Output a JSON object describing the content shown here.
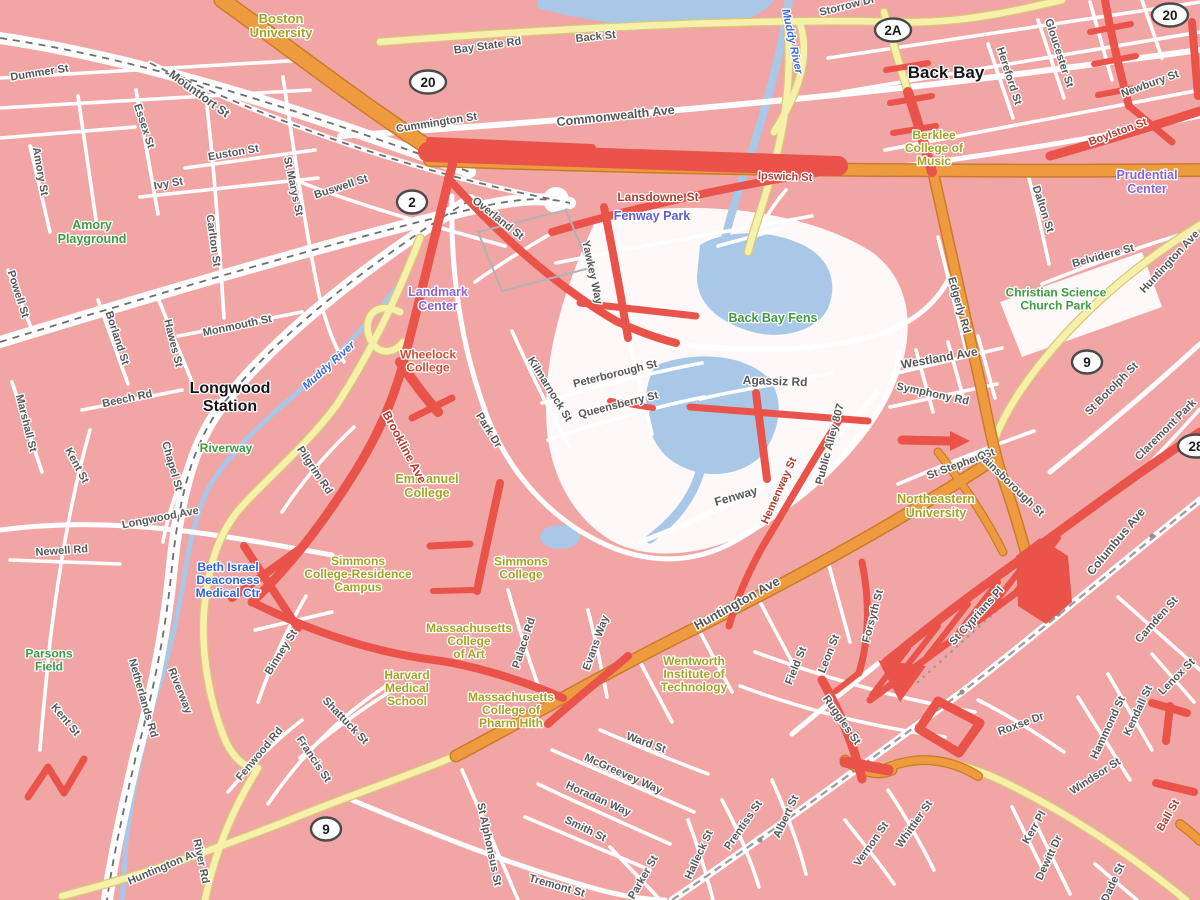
{
  "map_colors": {
    "land_pink": "#f2a5a5",
    "road_white": "#ffffff",
    "road_yellow": "#f7f0ab",
    "highway_orange": "#ee9b40",
    "traffic_heavy_red": "#e9534a",
    "water_blue": "#a9c8e8"
  },
  "labels": [
    {
      "t": "Boston\nUniversity",
      "x": 281,
      "y": 30,
      "c": "campus",
      "s": 13
    },
    {
      "t": "Amory\nPlayground",
      "x": 92,
      "y": 236,
      "c": "park",
      "s": 12.5
    },
    {
      "t": "Back Bay Fens",
      "x": 773,
      "y": 322,
      "c": "park",
      "s": 12.5
    },
    {
      "t": "Riverway",
      "x": 226,
      "y": 452,
      "c": "park",
      "s": 12
    },
    {
      "t": "Parsons\nField",
      "x": 49,
      "y": 664,
      "c": "park",
      "s": 12
    },
    {
      "t": "Christian Science\nChurch Park",
      "x": 1056,
      "y": 303,
      "c": "park",
      "s": 12
    },
    {
      "t": "Landmark\nCenter",
      "x": 438,
      "y": 303,
      "c": "poi-purple",
      "s": 12.5
    },
    {
      "t": "Prudential\nCenter",
      "x": 1147,
      "y": 186,
      "c": "poi-purple",
      "s": 12.5
    },
    {
      "t": "Fenway Park",
      "x": 652,
      "y": 220,
      "c": "fenway",
      "s": 12.5
    },
    {
      "t": "Lansdowne St",
      "x": 658,
      "y": 201,
      "c": "street-red",
      "s": 12
    },
    {
      "t": "Wheelock\nCollege",
      "x": 428,
      "y": 365,
      "c": "poi-red",
      "s": 12
    },
    {
      "t": "Beth Israel\nDeaconess\nMedical Ctr",
      "x": 228,
      "y": 584,
      "c": "poi-blue",
      "s": 12
    },
    {
      "t": "Berklee\nCollege of\nMusic",
      "x": 934,
      "y": 152,
      "c": "campus",
      "s": 12
    },
    {
      "t": "Emmanuel\nCollege",
      "x": 427,
      "y": 490,
      "c": "campus",
      "s": 12.5
    },
    {
      "t": "Simmons\nCollege-Residence\nCampus",
      "x": 358,
      "y": 578,
      "c": "campus",
      "s": 12
    },
    {
      "t": "Simmons\nCollege",
      "x": 521,
      "y": 572,
      "c": "campus",
      "s": 12
    },
    {
      "t": "Massachusetts\nCollege\nof Art",
      "x": 469,
      "y": 645,
      "c": "campus",
      "s": 12
    },
    {
      "t": "Harvard\nMedical\nSchool",
      "x": 407,
      "y": 692,
      "c": "campus",
      "s": 12
    },
    {
      "t": "Massachusetts\nCollege of\nPharm Hlth",
      "x": 511,
      "y": 714,
      "c": "campus",
      "s": 12
    },
    {
      "t": "Wentworth\nInstitute of\nTechnology",
      "x": 694,
      "y": 678,
      "c": "campus",
      "s": 12
    },
    {
      "t": "Northeastern\nUniversity",
      "x": 936,
      "y": 510,
      "c": "campus",
      "s": 12.5
    },
    {
      "t": "Back Bay",
      "x": 946,
      "y": 78,
      "c": "station",
      "s": 17
    },
    {
      "t": "Longwood\nStation",
      "x": 230,
      "y": 402,
      "c": "station",
      "s": 16
    },
    {
      "t": "Muddy River",
      "x": 331,
      "y": 368,
      "r": -42,
      "c": "water"
    },
    {
      "t": "Muddy River",
      "x": 789,
      "y": 42,
      "r": 78,
      "c": "water"
    },
    {
      "t": "Dummer St",
      "x": 40,
      "y": 76,
      "r": -9
    },
    {
      "t": "Mountfort St",
      "x": 197,
      "y": 97,
      "r": 36,
      "s": 12
    },
    {
      "t": "Essex St",
      "x": 141,
      "y": 127,
      "r": 72
    },
    {
      "t": "Euston St",
      "x": 234,
      "y": 156,
      "r": -10
    },
    {
      "t": "Ivy St",
      "x": 169,
      "y": 187,
      "r": -10
    },
    {
      "t": "Amory St",
      "x": 37,
      "y": 172,
      "r": 80
    },
    {
      "t": "Carlton St",
      "x": 210,
      "y": 241,
      "r": 82
    },
    {
      "t": "St Marys St",
      "x": 290,
      "y": 187,
      "r": 78
    },
    {
      "t": "Buswell St",
      "x": 342,
      "y": 190,
      "r": -18
    },
    {
      "t": "Cummington St",
      "x": 437,
      "y": 126,
      "r": -9
    },
    {
      "t": "Bay State Rd",
      "x": 488,
      "y": 49,
      "r": -8
    },
    {
      "t": "Back St",
      "x": 596,
      "y": 40,
      "r": -6
    },
    {
      "t": "Commonwealth Ave",
      "x": 616,
      "y": 120,
      "r": -6,
      "s": 12.5
    },
    {
      "t": "Storrow Dr",
      "x": 848,
      "y": 9,
      "r": -14
    },
    {
      "t": "Hereford St",
      "x": 1006,
      "y": 77,
      "r": 72
    },
    {
      "t": "Gloucester St",
      "x": 1056,
      "y": 54,
      "r": 72
    },
    {
      "t": "Newbury St",
      "x": 1151,
      "y": 87,
      "r": -20
    },
    {
      "t": "Boylston St",
      "x": 1119,
      "y": 135,
      "r": -20,
      "c": "street-red"
    },
    {
      "t": "Ipswich St",
      "x": 785,
      "y": 180,
      "r": 2,
      "c": "street-red"
    },
    {
      "t": "Dalton St",
      "x": 1040,
      "y": 210,
      "r": 72
    },
    {
      "t": "Belvidere St",
      "x": 1104,
      "y": 259,
      "r": -15
    },
    {
      "t": "Huntington Ave",
      "x": 1172,
      "y": 264,
      "r": -47
    },
    {
      "t": "Overland St",
      "x": 496,
      "y": 221,
      "r": 38
    },
    {
      "t": "Yawkey Way",
      "x": 589,
      "y": 273,
      "r": 78
    },
    {
      "t": "Kilmarnock St",
      "x": 547,
      "y": 391,
      "r": 58
    },
    {
      "t": "Peterborough St",
      "x": 616,
      "y": 377,
      "r": -14
    },
    {
      "t": "Queensberry St",
      "x": 619,
      "y": 408,
      "r": -14
    },
    {
      "t": "Park Dr",
      "x": 486,
      "y": 432,
      "r": 58
    },
    {
      "t": "Brookline Ave",
      "x": 401,
      "y": 449,
      "r": 62,
      "c": "street-red",
      "s": 12
    },
    {
      "t": "Agassiz Rd",
      "x": 775,
      "y": 385,
      "r": 2,
      "s": 12
    },
    {
      "t": "Westland Ave",
      "x": 940,
      "y": 362,
      "r": -10,
      "s": 12
    },
    {
      "t": "Symphony Rd",
      "x": 932,
      "y": 397,
      "r": 12
    },
    {
      "t": "St Stephen St",
      "x": 962,
      "y": 467,
      "r": -20
    },
    {
      "t": "Public Alley 807",
      "x": 833,
      "y": 445,
      "r": -75
    },
    {
      "t": "Hemenway St",
      "x": 782,
      "y": 492,
      "r": -66,
      "c": "street-red"
    },
    {
      "t": "Fenway",
      "x": 737,
      "y": 500,
      "r": -16,
      "s": 12
    },
    {
      "t": "Edgerly Rd",
      "x": 956,
      "y": 306,
      "r": 74
    },
    {
      "t": "St Botolph St",
      "x": 1114,
      "y": 391,
      "r": -45
    },
    {
      "t": "Claremont Park",
      "x": 1168,
      "y": 432,
      "r": -45
    },
    {
      "t": "Gainsborough St",
      "x": 1008,
      "y": 486,
      "r": 44
    },
    {
      "t": "Huntington Ave",
      "x": 739,
      "y": 607,
      "r": -29,
      "s": 13
    },
    {
      "t": "Forsyth St",
      "x": 876,
      "y": 617,
      "r": -75
    },
    {
      "t": "Leon St",
      "x": 832,
      "y": 655,
      "r": -68
    },
    {
      "t": "Field St",
      "x": 799,
      "y": 667,
      "r": -68
    },
    {
      "t": "Ruggles St",
      "x": 839,
      "y": 722,
      "r": 55
    },
    {
      "t": "St Cyprians Pl",
      "x": 979,
      "y": 618,
      "r": -48
    },
    {
      "t": "Columbus Ave",
      "x": 1119,
      "y": 544,
      "r": -50,
      "s": 12
    },
    {
      "t": "Camden St",
      "x": 1159,
      "y": 622,
      "r": -48
    },
    {
      "t": "Lenox St",
      "x": 1179,
      "y": 679,
      "r": -45
    },
    {
      "t": "Kendall St",
      "x": 1141,
      "y": 712,
      "r": -65
    },
    {
      "t": "Hammond St",
      "x": 1111,
      "y": 729,
      "r": -65
    },
    {
      "t": "Windsor St",
      "x": 1097,
      "y": 779,
      "r": -33
    },
    {
      "t": "Ball St",
      "x": 1171,
      "y": 817,
      "r": -60,
      "c": "street-red"
    },
    {
      "t": "Roxse Dr",
      "x": 1022,
      "y": 727,
      "r": -20
    },
    {
      "t": "Kerr Pl",
      "x": 1037,
      "y": 829,
      "r": -60
    },
    {
      "t": "Dewitt Dr",
      "x": 1052,
      "y": 859,
      "r": -65
    },
    {
      "t": "Dade St",
      "x": 1116,
      "y": 884,
      "r": -65
    },
    {
      "t": "Whittier St",
      "x": 917,
      "y": 826,
      "r": -55
    },
    {
      "t": "Vernon St",
      "x": 874,
      "y": 846,
      "r": -55
    },
    {
      "t": "Albert St",
      "x": 789,
      "y": 818,
      "r": -65
    },
    {
      "t": "Prentiss St",
      "x": 746,
      "y": 827,
      "r": -55
    },
    {
      "t": "Halleck St",
      "x": 702,
      "y": 856,
      "r": -65
    },
    {
      "t": "Parker St",
      "x": 646,
      "y": 879,
      "r": -60
    },
    {
      "t": "Smith St",
      "x": 584,
      "y": 832,
      "r": 26
    },
    {
      "t": "Horadan Way",
      "x": 597,
      "y": 802,
      "r": 24
    },
    {
      "t": "McGreevey Way",
      "x": 622,
      "y": 777,
      "r": 24
    },
    {
      "t": "Ward St",
      "x": 645,
      "y": 746,
      "r": 20
    },
    {
      "t": "St Alphonsus St",
      "x": 486,
      "y": 845,
      "r": 78
    },
    {
      "t": "Tremont St",
      "x": 556,
      "y": 889,
      "r": 16
    },
    {
      "t": "Huntington Ave",
      "x": 167,
      "y": 869,
      "r": -23
    },
    {
      "t": "River Rd",
      "x": 198,
      "y": 862,
      "r": 78
    },
    {
      "t": "Netherlands Rd",
      "x": 140,
      "y": 699,
      "r": 74
    },
    {
      "t": "Riverway",
      "x": 177,
      "y": 692,
      "r": 68
    },
    {
      "t": "Longwood Ave",
      "x": 161,
      "y": 521,
      "r": -11
    },
    {
      "t": "Newell Rd",
      "x": 62,
      "y": 554,
      "r": -4
    },
    {
      "t": "Kent St",
      "x": 74,
      "y": 467,
      "r": 62
    },
    {
      "t": "Kent St",
      "x": 63,
      "y": 722,
      "r": 50
    },
    {
      "t": "Chapel St",
      "x": 169,
      "y": 467,
      "r": 74
    },
    {
      "t": "Monmouth St",
      "x": 238,
      "y": 329,
      "r": -12
    },
    {
      "t": "Beech Rd",
      "x": 128,
      "y": 402,
      "r": -12
    },
    {
      "t": "Marshall St",
      "x": 23,
      "y": 424,
      "r": 76
    },
    {
      "t": "Powell St",
      "x": 15,
      "y": 295,
      "r": 72
    },
    {
      "t": "Borland St",
      "x": 114,
      "y": 339,
      "r": 72
    },
    {
      "t": "Hawes St",
      "x": 170,
      "y": 344,
      "r": 76
    },
    {
      "t": "Pilgrim Rd",
      "x": 312,
      "y": 472,
      "r": 56
    },
    {
      "t": "Binney St",
      "x": 284,
      "y": 654,
      "r": -58
    },
    {
      "t": "Shattuck St",
      "x": 343,
      "y": 723,
      "r": 46
    },
    {
      "t": "Francis St",
      "x": 311,
      "y": 761,
      "r": 56
    },
    {
      "t": "Fenwood Rd",
      "x": 262,
      "y": 756,
      "r": -50
    },
    {
      "t": "Palace Rd",
      "x": 527,
      "y": 644,
      "r": -72
    },
    {
      "t": "Evans Way",
      "x": 599,
      "y": 644,
      "r": -70
    }
  ],
  "shields": [
    {
      "n": "20",
      "x": 428,
      "y": 82
    },
    {
      "n": "2",
      "x": 412,
      "y": 202
    },
    {
      "n": "2A",
      "x": 893,
      "y": 30
    },
    {
      "n": "20",
      "x": 1170,
      "y": 15
    },
    {
      "n": "9",
      "x": 1087,
      "y": 362
    },
    {
      "n": "9",
      "x": 326,
      "y": 829
    },
    {
      "n": "28",
      "x": 1196,
      "y": 446
    }
  ]
}
